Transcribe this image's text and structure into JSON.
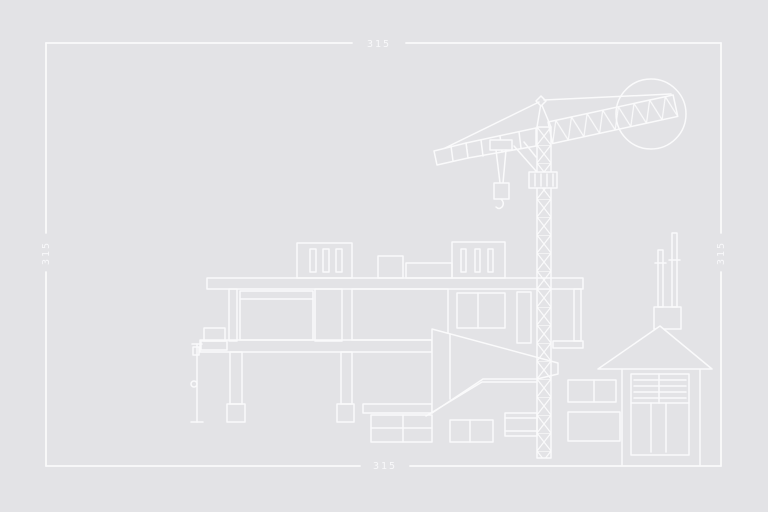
{
  "colors": {
    "background": "#e3e3e6",
    "line": "#fafafb"
  },
  "frame": {
    "dimension_top": "315",
    "dimension_bottom": "315",
    "dimension_left": "315",
    "dimension_right": "315"
  },
  "scene": {
    "elements": [
      "border-frame",
      "sun-circle",
      "tower-crane",
      "modern-building",
      "pilotis-columns",
      "material-stacks",
      "surveyor-pole",
      "debris-chute",
      "gable-house",
      "garage-door",
      "chimney-rods"
    ]
  }
}
